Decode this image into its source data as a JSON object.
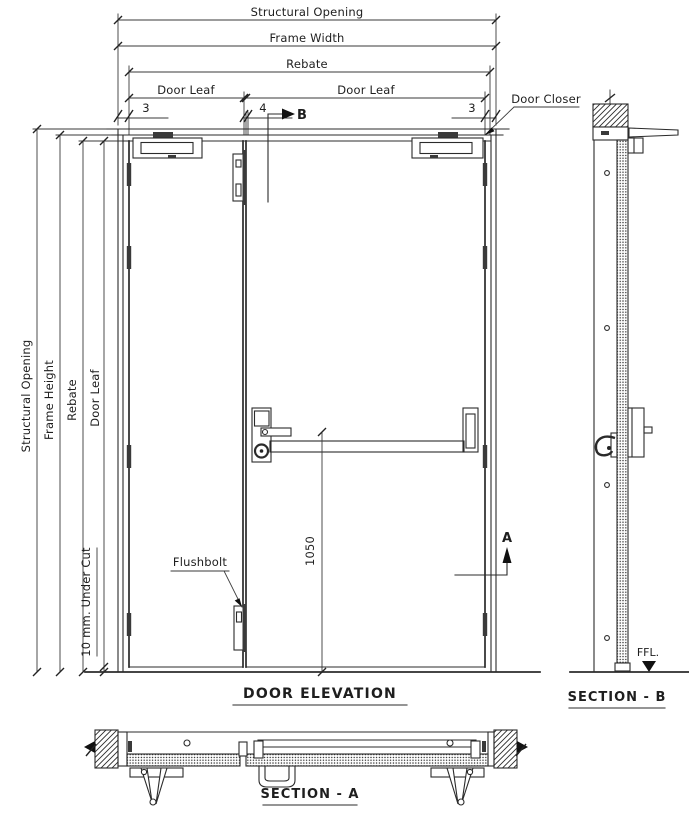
{
  "colors": {
    "background": "#ffffff",
    "line": "#2b2b2b"
  },
  "top_dimensions": {
    "structural_opening": "Structural Opening",
    "frame_width": "Frame Width",
    "rebate": "Rebate",
    "door_leaf_left": "Door Leaf",
    "door_leaf_right": "Door Leaf",
    "gap_left": "3",
    "gap_middle": "4",
    "gap_right": "3"
  },
  "left_dimensions": {
    "structural_opening": "Structural Opening",
    "frame_height": "Frame Height",
    "rebate": "Rebate",
    "door_leaf": "Door Leaf",
    "under_cut": "10 mm. Under Cut"
  },
  "callouts": {
    "door_closer": "Door Closer",
    "flushbolt": "Flushbolt",
    "bar_height": "1050",
    "section_b_marker": "B",
    "section_a_marker": "A",
    "ffl": "FFL."
  },
  "view_titles": {
    "elevation": "DOOR ELEVATION",
    "section_b": "SECTION - B",
    "section_a": "SECTION - A"
  }
}
